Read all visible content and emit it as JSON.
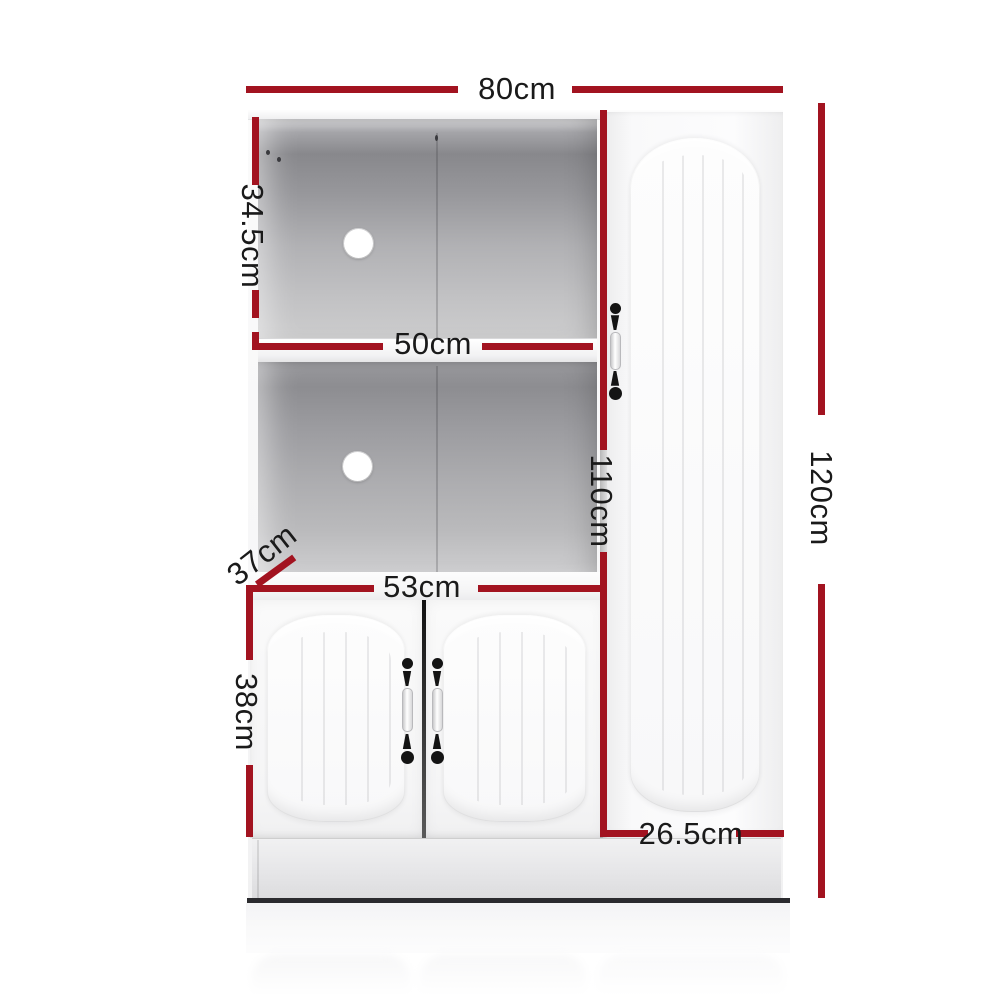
{
  "diagram": {
    "subject": "white buffet sideboard cupboard dimension diagram",
    "accent_color": "#A21320",
    "text_color": "#1a1a1a",
    "labels": {
      "width_top": "80cm",
      "upper_shelf_height": "34.5cm",
      "inner_shelf_width": "50cm",
      "left_section_height": "110cm",
      "total_height": "120cm",
      "depth": "37cm",
      "lower_doors_width": "53cm",
      "lower_doors_height": "38cm",
      "right_door_width": "26.5cm"
    }
  }
}
